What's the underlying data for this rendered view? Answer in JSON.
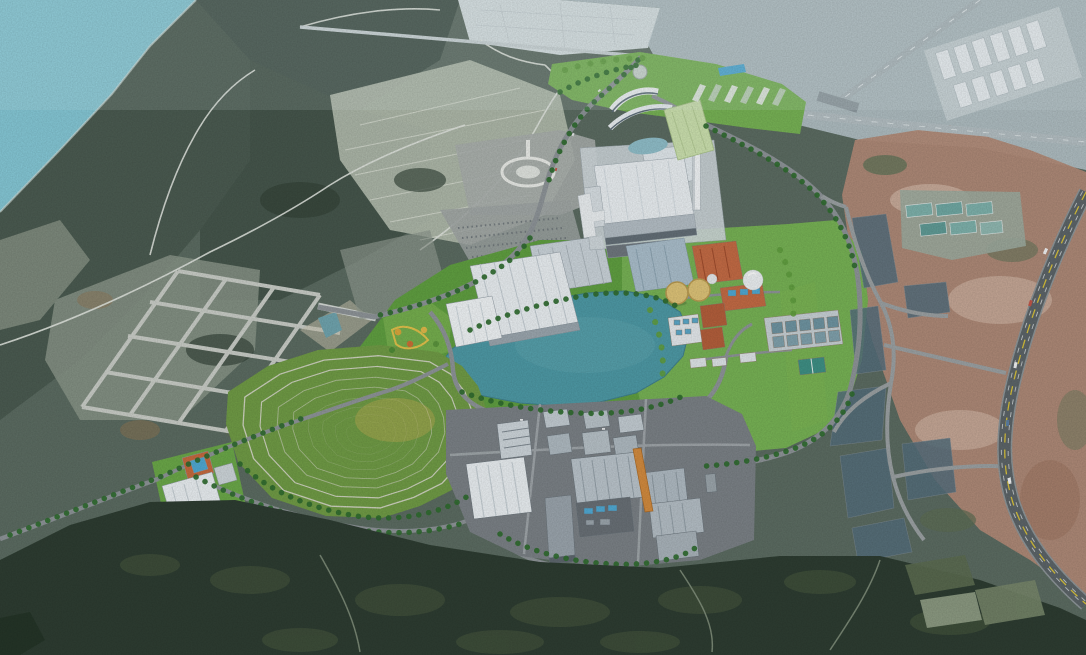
{
  "scene": {
    "alt": "Aerial 3D architectural rendering of a planned industrial park set into hilly coastal farmland: a teal lake at center, a terraced contour-ringed hill, white logistics warehouses, an orange-brick water-treatment cluster with storage tanks, a large white power plant with chimney, a southern factory campus, a planned road grid on the left, a curving highway over red bare earth on the right, dark forest along the bottom and sea water in the top-left corner. No visible text or watermarks.",
    "visible_text": "none",
    "regions": [
      {
        "name": "sea-water",
        "desc": "coastal water, top-left corner"
      },
      {
        "name": "mountain-farmland",
        "desc": "terraced hills and fields, left and top"
      },
      {
        "name": "planned-road-grid",
        "desc": "slanted grid of new empty roads, left-center"
      },
      {
        "name": "terraced-hill",
        "desc": "concentric contour-ringed landscaped hill, lower-left of park"
      },
      {
        "name": "central-lake",
        "desc": "teal landscaped lake at park center"
      },
      {
        "name": "lakeside-warehouses",
        "desc": "white-roof logistics warehouses northwest of lake"
      },
      {
        "name": "power-plant",
        "desc": "large white plant building with chimney, top-center"
      },
      {
        "name": "north-campus",
        "desc": "offices, green-roof hall, shed rows, blue pool"
      },
      {
        "name": "treatment-cluster",
        "desc": "orange brick buildings, yellow tanks, sphere, aeration basins on east lawn"
      },
      {
        "name": "south-campus",
        "desc": "gray factory buildings with orange conveyor, bottom-center"
      },
      {
        "name": "west-facility",
        "desc": "small white warehouse with court and pool, lower-left"
      },
      {
        "name": "right-parcels",
        "desc": "dark graded land parcels with new roads, right side"
      },
      {
        "name": "highway",
        "desc": "curving highway with yellow centerline over red earth, right"
      },
      {
        "name": "logistics-cluster-far",
        "desc": "white warehouse roofs, top-right distance"
      },
      {
        "name": "south-forest",
        "desc": "dark forest band across the bottom"
      }
    ],
    "counts": {
      "terrace_rings": 8,
      "storage_tanks": 2,
      "gas_sphere": 1,
      "basin_cells": 10
    }
  },
  "colors": {
    "terrain_base": "#5b6b61",
    "mountain_dark": "#42524a",
    "mountain_mid": "#4a5a50",
    "farmland_light": "#b3bdae",
    "field_patch": "#8a9588",
    "sea": "#84c6d4",
    "flats": "#dde6e8",
    "haze": "#b6c4ca",
    "earth_red": "#b18a77",
    "earth_light": "#cdb2a1",
    "forest": "#2d3c31",
    "lawn": "#76b154",
    "park_band": "#5f9e40",
    "lake": "#4d98a4",
    "lake_sheen": "#63aab4",
    "hill_base": "#6f9a45",
    "hill_ring": "#d8d8cc",
    "hill_meadow": "#c8ab56",
    "road_park": "#8d9397",
    "road_grid": "#c8ccc6",
    "road_rural": "#e0e4de",
    "road_parcel": "#9aa0a2",
    "highway": "#5c6468",
    "highway_yellow": "#d7c13b",
    "lane_white": "#d8dcdd",
    "parcel_fill": "#546e7c",
    "roof_white": "#e8edf0",
    "roof_gray": "#b9c3ca",
    "roof_orange": "#c26a44",
    "tank_yellow": "#dcc277",
    "sphere_white": "#eaeef0",
    "pool_blue": "#4fa8d2",
    "campus_pad": "#7a8085",
    "plant_pad": "#cfd7db",
    "tree_dark": "#2f6b2f",
    "tree_mid": "#5f9c3e",
    "tree_autumn": "#d9a63c",
    "basin_water": "#6e93a0",
    "teal_roof": "#7db0aa",
    "conveyor_orange": "#d18a3e",
    "green_roof_hall": "#cadfad"
  }
}
